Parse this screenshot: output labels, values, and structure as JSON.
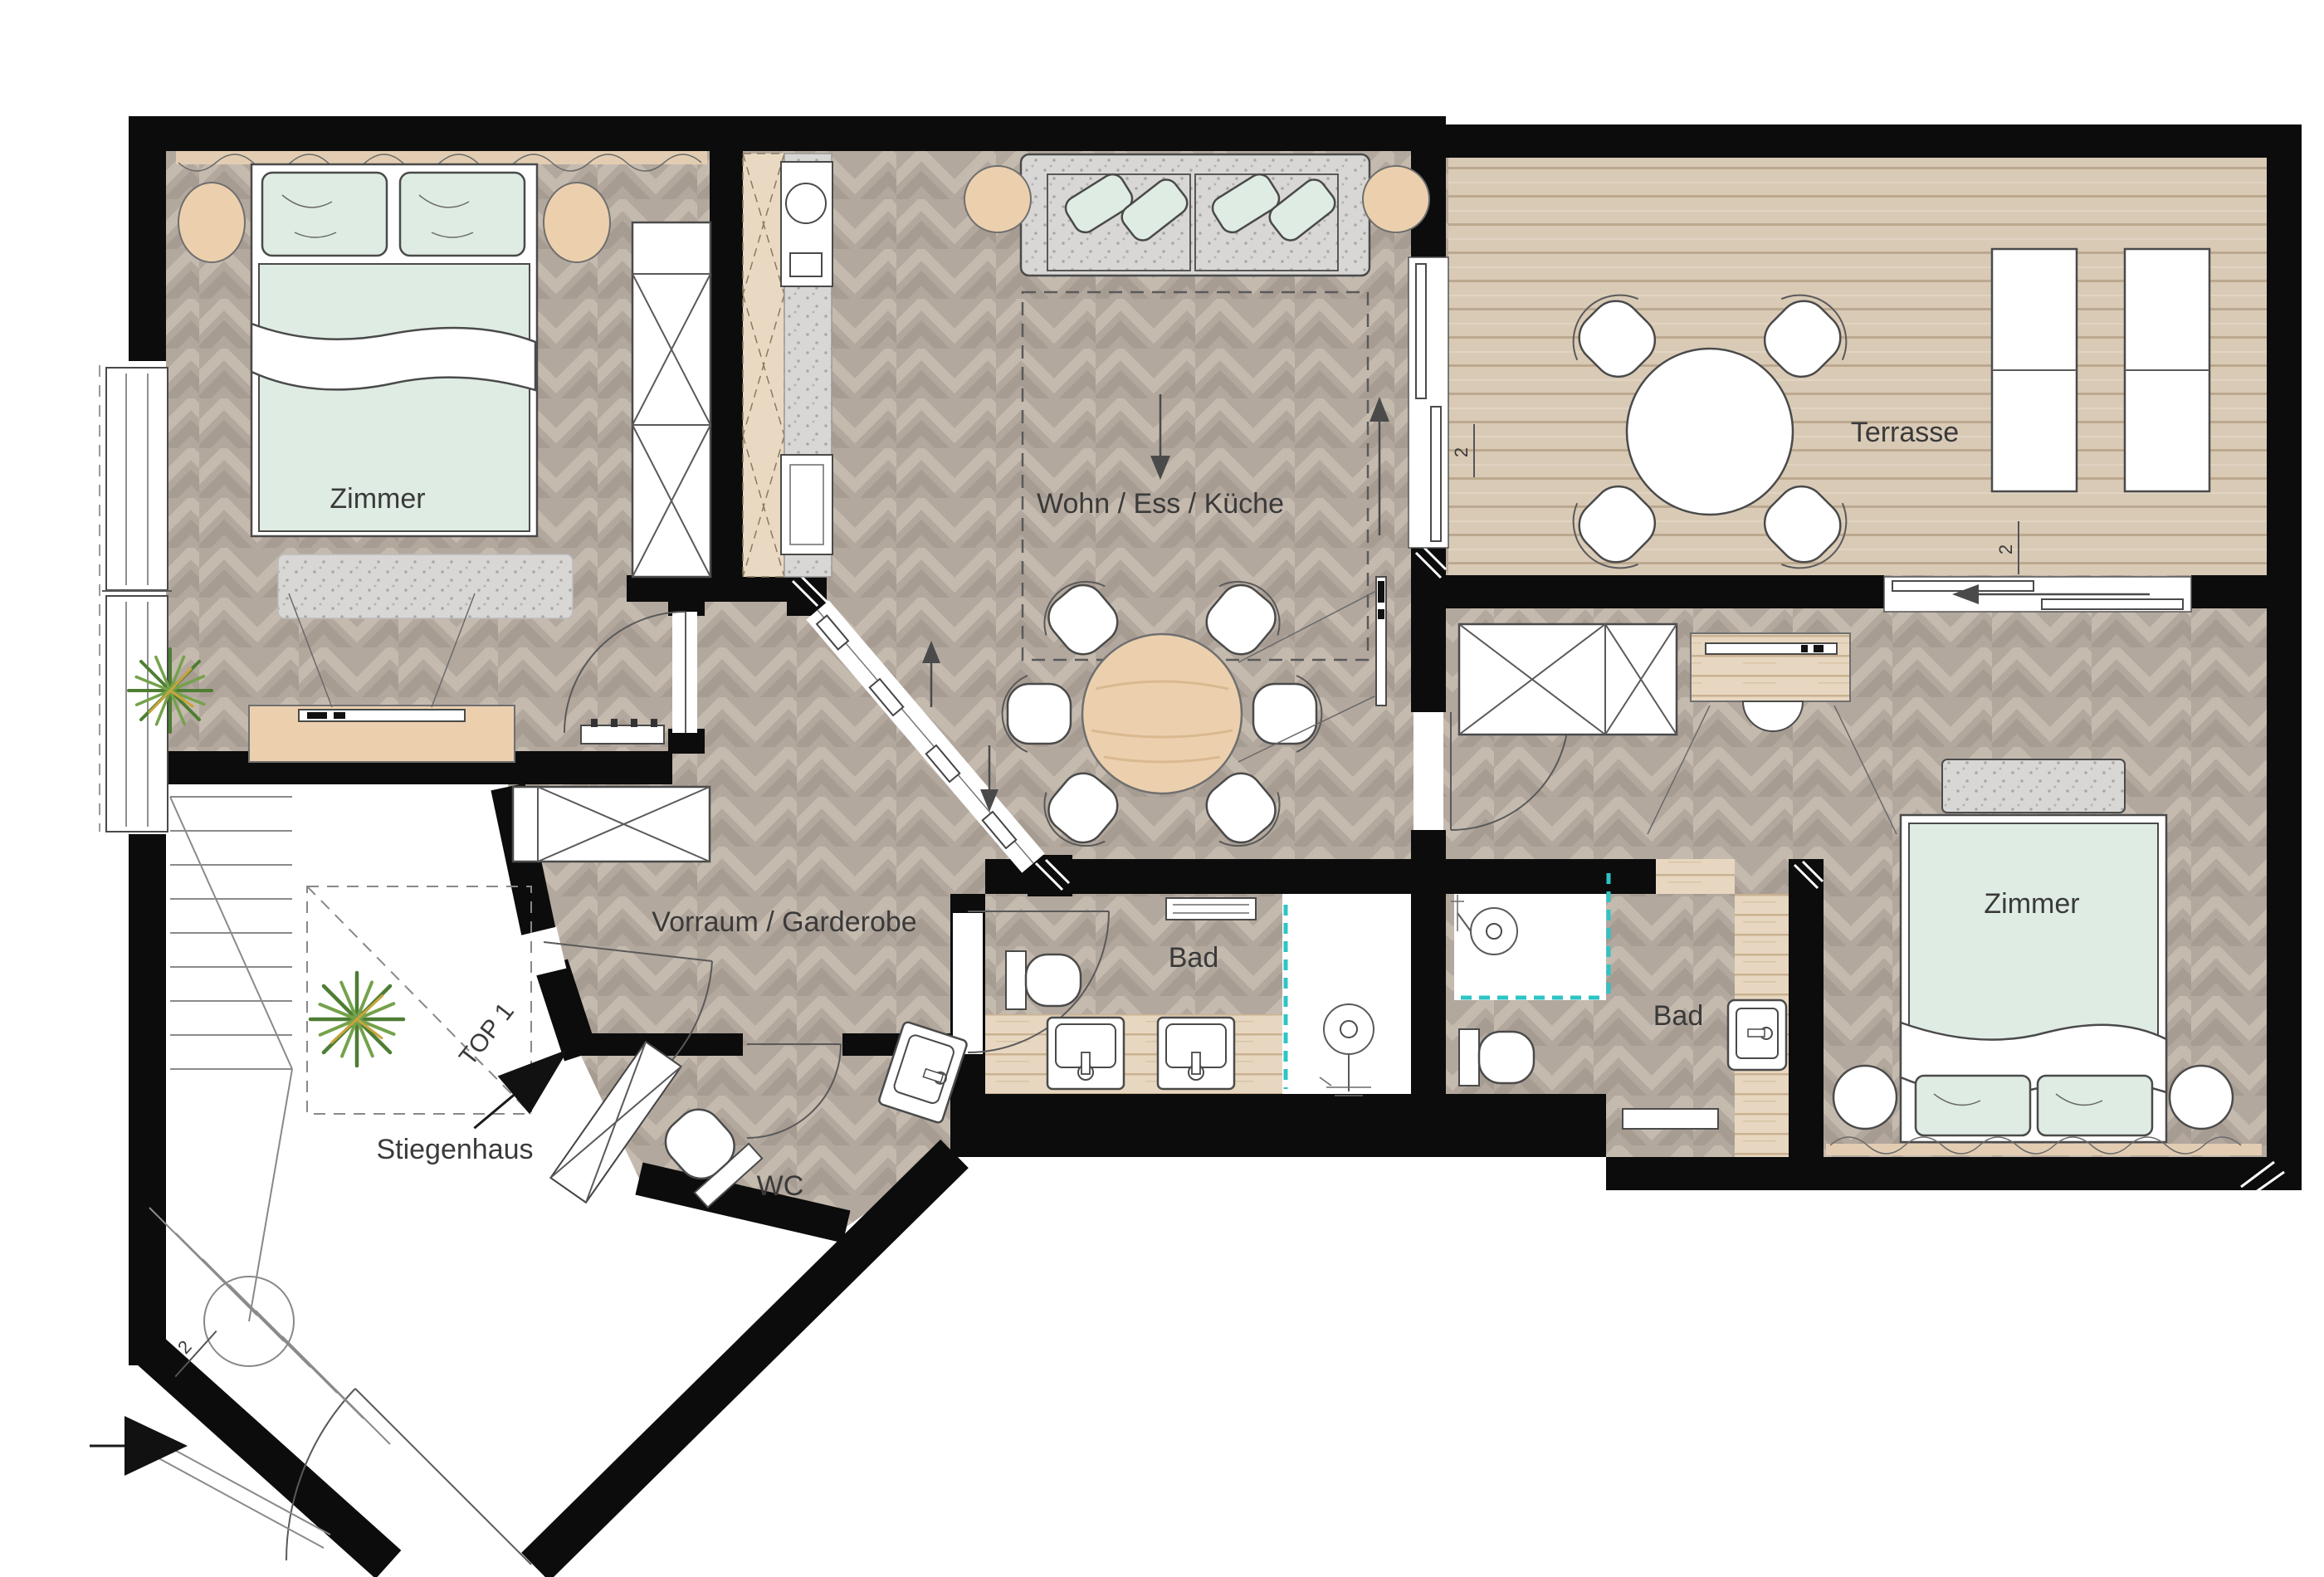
{
  "document": {
    "type": "apartment-floor-plan",
    "unit_marker": "TOP 1",
    "section_marker": "2"
  },
  "rooms": {
    "zimmer_left": {
      "label": "Zimmer"
    },
    "wohn_ess_kueche": {
      "label": "Wohn / Ess / Küche"
    },
    "terrasse": {
      "label": "Terrasse"
    },
    "zimmer_right": {
      "label": "Zimmer"
    },
    "vorraum_garderobe": {
      "label": "Vorraum / Garderobe"
    },
    "bad_left": {
      "label": "Bad"
    },
    "bad_right": {
      "label": "Bad"
    },
    "wc": {
      "label": "WC"
    },
    "stiegenhaus": {
      "label": "Stiegenhaus"
    }
  },
  "markers": {
    "unit": "TOP 1",
    "section": "2"
  },
  "colors": {
    "wall": "#0c0c0c",
    "floor_base": "#b3a89e",
    "floor_chevron_light": "#c5baae",
    "floor_chevron_dark": "#a79c92",
    "terrace_deck": "#d9cab6",
    "terrace_line": "#bca88e",
    "wood_light": "#e8d7c0",
    "wood_cabinet": "#ead9c2",
    "wood_grain": "#c9b291",
    "mint": "#dfece3",
    "tan": "#ecd0ae",
    "gray_fabric": "#d8d7d5",
    "outline": "#555555",
    "text": "#3a3a3a",
    "teal": "#2ec4c6",
    "plant_green": "#4e7d34"
  }
}
